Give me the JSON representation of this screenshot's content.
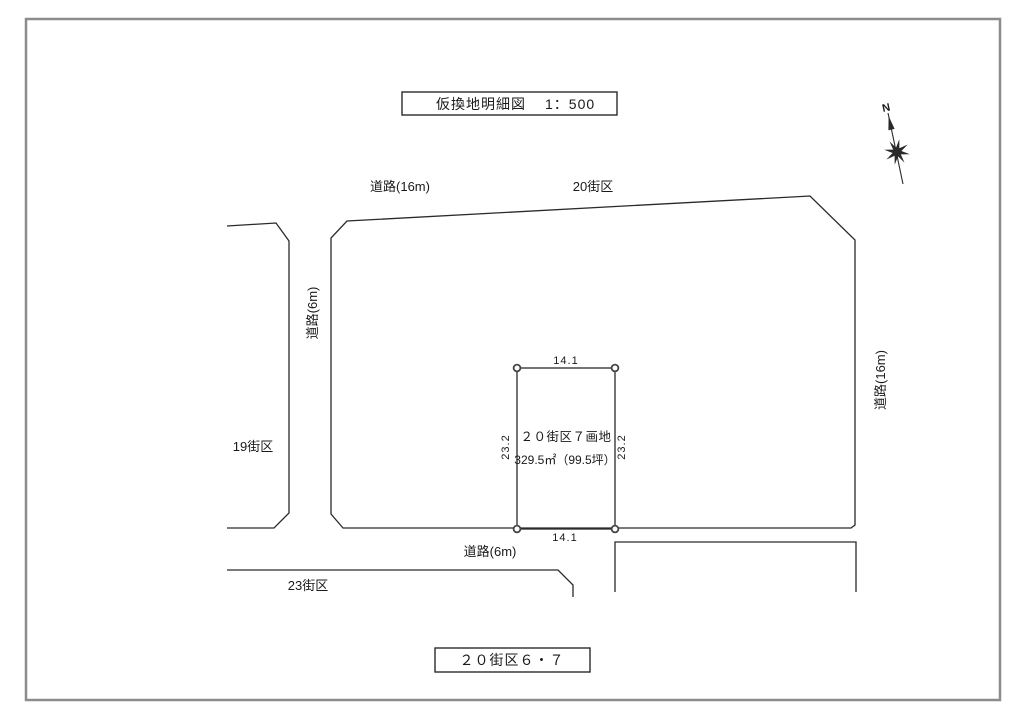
{
  "drawing": {
    "title_box": {
      "title": "仮換地明細図",
      "scale": "1：500"
    },
    "footer_box": {
      "label": "２０街区６・７"
    },
    "north": {
      "label": "N"
    },
    "roads": {
      "top": "道路(16m)",
      "left": "道路(6m)",
      "right": "道路(16m)",
      "bottom": "道路(6m)"
    },
    "blocks": {
      "block20": "20街区",
      "block19": "19街区",
      "block23": "23街区"
    },
    "parcel": {
      "name": "２０街区７画地",
      "area": "329.5㎡（99.5坪）",
      "dim_top": "14.1",
      "dim_bottom": "14.1",
      "dim_left": "23.2",
      "dim_right": "23.2"
    },
    "colors": {
      "line": "#2a2a2a",
      "frame": "#8c8c8c",
      "background": "#ffffff",
      "text": "#1a1a1a"
    }
  }
}
